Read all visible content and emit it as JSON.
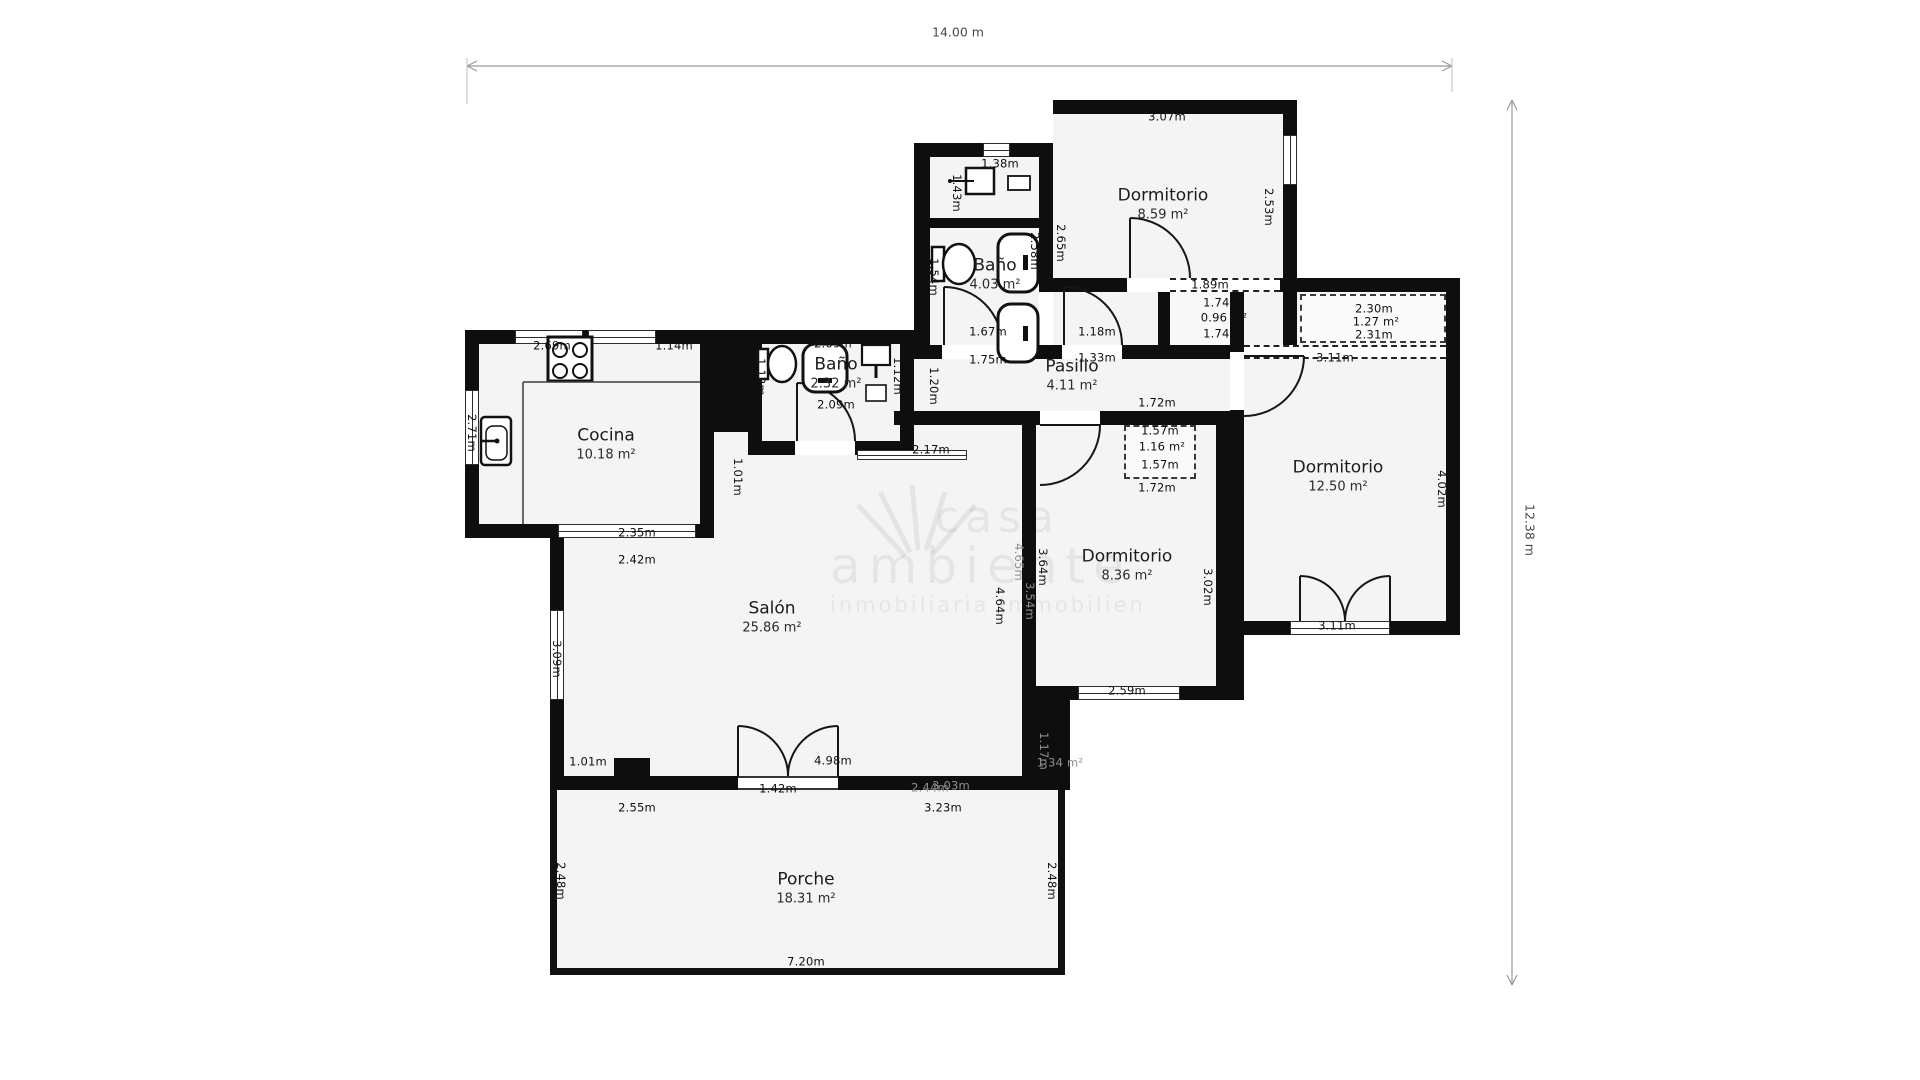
{
  "scale": {
    "width_label": "14.00 m",
    "height_label": "12.38 m"
  },
  "watermark": {
    "line1": "casa",
    "line2": "ambiente",
    "line3": "inmobiliaria immobilien"
  },
  "rooms": [
    {
      "id": "dormitorio-top",
      "name": "Dormitorio",
      "area": "8.59 m²",
      "x": 1163,
      "y": 204
    },
    {
      "id": "bano-1",
      "name": "Baño",
      "area": "4.03 m²",
      "x": 995,
      "y": 274
    },
    {
      "id": "cocina",
      "name": "Cocina",
      "area": "10.18 m²",
      "x": 606,
      "y": 444
    },
    {
      "id": "bano-2",
      "name": "Baño",
      "area": "2.32 m²",
      "x": 836,
      "y": 373
    },
    {
      "id": "pasillo",
      "name": "Pasillo",
      "area": "4.11 m²",
      "x": 1072,
      "y": 375
    },
    {
      "id": "dormitorio-right",
      "name": "Dormitorio",
      "area": "12.50 m²",
      "x": 1338,
      "y": 476
    },
    {
      "id": "dormitorio-mid",
      "name": "Dormitorio",
      "area": "8.36 m²",
      "x": 1127,
      "y": 565
    },
    {
      "id": "salon",
      "name": "Salón",
      "area": "25.86 m²",
      "x": 772,
      "y": 617
    },
    {
      "id": "porche",
      "name": "Porche",
      "area": "18.31 m²",
      "x": 806,
      "y": 888
    }
  ],
  "dims": [
    {
      "t": "3.07m",
      "x": 1167,
      "y": 117
    },
    {
      "t": "1.38m",
      "x": 1000,
      "y": 164
    },
    {
      "t": "1.43m",
      "x": 956,
      "y": 193,
      "v": 1
    },
    {
      "t": "2.53m",
      "x": 1268,
      "y": 207,
      "v": 1
    },
    {
      "t": "2.65m",
      "x": 1060,
      "y": 243,
      "v": 1
    },
    {
      "t": "2.58m",
      "x": 1034,
      "y": 251,
      "v": 1
    },
    {
      "t": "1.54m",
      "x": 933,
      "y": 277,
      "v": 1
    },
    {
      "t": "1.89m",
      "x": 1210,
      "y": 285
    },
    {
      "t": "1.74m",
      "x": 1222,
      "y": 303
    },
    {
      "t": "0.96 m²",
      "x": 1224,
      "y": 318
    },
    {
      "t": "1.74m",
      "x": 1222,
      "y": 334
    },
    {
      "t": "2.30m",
      "x": 1374,
      "y": 309
    },
    {
      "t": "1.27 m²",
      "x": 1376,
      "y": 322
    },
    {
      "t": "2.31m",
      "x": 1374,
      "y": 335
    },
    {
      "t": "1.67m",
      "x": 988,
      "y": 332
    },
    {
      "t": "1.18m",
      "x": 1097,
      "y": 332
    },
    {
      "t": "1.75m",
      "x": 988,
      "y": 360
    },
    {
      "t": "1.33m",
      "x": 1097,
      "y": 358
    },
    {
      "t": "3.11m",
      "x": 1335,
      "y": 358
    },
    {
      "t": "2.69m",
      "x": 552,
      "y": 346
    },
    {
      "t": "1.14m",
      "x": 674,
      "y": 346
    },
    {
      "t": "2.09m",
      "x": 833,
      "y": 344
    },
    {
      "t": "2.09m",
      "x": 836,
      "y": 405
    },
    {
      "t": "1.12m",
      "x": 897,
      "y": 376,
      "v": 1
    },
    {
      "t": "1.12m",
      "x": 760,
      "y": 377,
      "v": 1
    },
    {
      "t": "1.20m",
      "x": 933,
      "y": 386,
      "v": 1
    },
    {
      "t": "1.72m",
      "x": 1157,
      "y": 403
    },
    {
      "t": "1.57m",
      "x": 1160,
      "y": 431
    },
    {
      "t": "1.16 m²",
      "x": 1162,
      "y": 447
    },
    {
      "t": "1.57m",
      "x": 1160,
      "y": 465
    },
    {
      "t": "1.72m",
      "x": 1157,
      "y": 488
    },
    {
      "t": "2.17m",
      "x": 931,
      "y": 450
    },
    {
      "t": "2.71m",
      "x": 471,
      "y": 433,
      "v": 1
    },
    {
      "t": "2.94m",
      "x": 708,
      "y": 427,
      "v": 1
    },
    {
      "t": "1.01m",
      "x": 737,
      "y": 477,
      "v": 1
    },
    {
      "t": "2.35m",
      "x": 637,
      "y": 533
    },
    {
      "t": "2.42m",
      "x": 637,
      "y": 560
    },
    {
      "t": "4.02m",
      "x": 1238,
      "y": 489,
      "v": 1
    },
    {
      "t": "4.02m",
      "x": 1441,
      "y": 489,
      "v": 1
    },
    {
      "t": "3.64m",
      "x": 1042,
      "y": 567,
      "v": 1
    },
    {
      "t": "4.64m",
      "x": 999,
      "y": 606,
      "v": 1
    },
    {
      "t": "4.65m",
      "x": 1018,
      "y": 562,
      "v": 1,
      "f": 1
    },
    {
      "t": "3.54m",
      "x": 1029,
      "y": 601,
      "v": 1,
      "f": 1
    },
    {
      "t": "3.02m",
      "x": 1207,
      "y": 587,
      "v": 1
    },
    {
      "t": "3.09m",
      "x": 556,
      "y": 659,
      "v": 1
    },
    {
      "t": "3.11m",
      "x": 1337,
      "y": 626
    },
    {
      "t": "2.59m",
      "x": 1127,
      "y": 691
    },
    {
      "t": "1.17m",
      "x": 1043,
      "y": 751,
      "v": 1,
      "f": 1
    },
    {
      "t": "1.34 m²",
      "x": 1060,
      "y": 763,
      "f": 1
    },
    {
      "t": "1.01m",
      "x": 588,
      "y": 762
    },
    {
      "t": "4.98m",
      "x": 833,
      "y": 761
    },
    {
      "t": "1.42m",
      "x": 778,
      "y": 789
    },
    {
      "t": "2.44m",
      "x": 930,
      "y": 788,
      "f": 1
    },
    {
      "t": "3.03m",
      "x": 951,
      "y": 786,
      "f": 1
    },
    {
      "t": "2.55m",
      "x": 637,
      "y": 808
    },
    {
      "t": "3.23m",
      "x": 943,
      "y": 808
    },
    {
      "t": "2.48m",
      "x": 560,
      "y": 881,
      "v": 1
    },
    {
      "t": "2.48m",
      "x": 1051,
      "y": 881,
      "v": 1
    },
    {
      "t": "7.20m",
      "x": 806,
      "y": 962
    }
  ]
}
